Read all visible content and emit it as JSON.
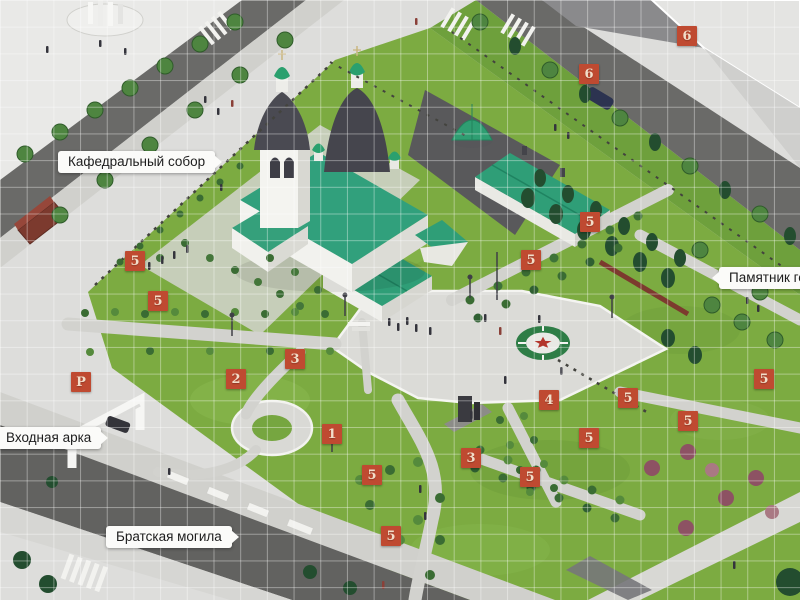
{
  "map": {
    "type": "isometric-park-masterplan",
    "labels": {
      "cathedral": "Кафедральный собор",
      "entrance_arch": "Входная арка",
      "mass_grave": "Братская могила",
      "monument": "Памятник гер"
    },
    "markers": [
      {
        "label": "6",
        "x": 677,
        "y": 26
      },
      {
        "label": "6",
        "x": 579,
        "y": 64
      },
      {
        "label": "5",
        "x": 125,
        "y": 251
      },
      {
        "label": "5",
        "x": 148,
        "y": 291
      },
      {
        "label": "5",
        "x": 580,
        "y": 212
      },
      {
        "label": "5",
        "x": 521,
        "y": 250
      },
      {
        "label": "3",
        "x": 285,
        "y": 349
      },
      {
        "label": "2",
        "x": 226,
        "y": 369
      },
      {
        "label": "1",
        "x": 322,
        "y": 424
      },
      {
        "label": "4",
        "x": 539,
        "y": 390
      },
      {
        "label": "5",
        "x": 579,
        "y": 428
      },
      {
        "label": "3",
        "x": 461,
        "y": 448
      },
      {
        "label": "5",
        "x": 520,
        "y": 467
      },
      {
        "label": "5",
        "x": 618,
        "y": 388
      },
      {
        "label": "5",
        "x": 678,
        "y": 411
      },
      {
        "label": "5",
        "x": 754,
        "y": 369
      },
      {
        "label": "5",
        "x": 362,
        "y": 465
      },
      {
        "label": "5",
        "x": 381,
        "y": 526
      },
      {
        "label": "P",
        "x": 71,
        "y": 372
      }
    ],
    "colors": {
      "marker_bg": "#bf4a31",
      "marker_text": "#f2ddc9",
      "label_bg": "#fbfbf9",
      "label_text": "#1d1d1d",
      "grass": "#7cab41",
      "road": "#6a6a68",
      "path": "#d2d2ce",
      "roof_teal": "#2f9e77",
      "dome_dark": "#4a4a52",
      "grid_line": "rgba(255,255,255,0.38)"
    }
  }
}
